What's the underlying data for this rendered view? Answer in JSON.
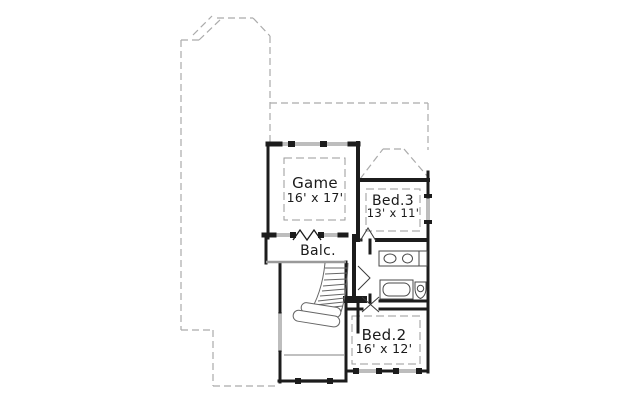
{
  "floor_plan": {
    "rooms": {
      "game": {
        "label": "Game",
        "dims": "16' x 17'"
      },
      "bed3": {
        "label": "Bed.3",
        "dims": "13' x 11'"
      },
      "balcony": {
        "label": "Balc."
      },
      "bed2": {
        "label": "Bed.2",
        "dims": "16' x 12'"
      }
    },
    "colors": {
      "wall": "#1c1c1c",
      "dashed_outline": "#ababab",
      "ceiling_dash": "#9a9a9a",
      "window_glass": "#bdbdbd",
      "balcony_edge": "#9a9a9a",
      "fixture_line": "#4a4a4a",
      "background": "#ffffff"
    }
  }
}
